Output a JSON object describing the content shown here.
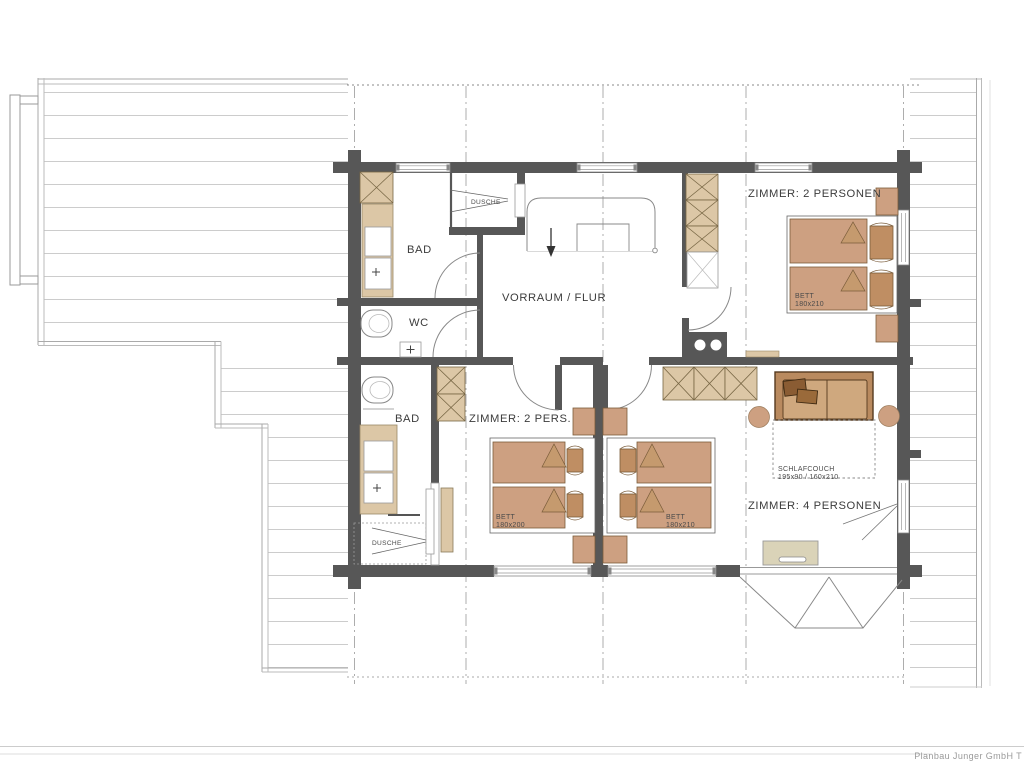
{
  "plan": {
    "rooms": {
      "bad_upper": {
        "name": "BAD"
      },
      "shower_upper": {
        "name": "DUSCHE"
      },
      "wc": {
        "name": "WC"
      },
      "hall": {
        "name": "VORRAUM / FLUR"
      },
      "bad_lower": {
        "name": "BAD"
      },
      "shower_lower": {
        "name": "DUSCHE"
      },
      "bedroom_small": {
        "name": "ZIMMER: 2 PERS."
      },
      "bedroom_top": {
        "name": "ZIMMER: 2 PERSONEN"
      },
      "bedroom_large": {
        "name": "ZIMMER: 4 PERSONEN"
      }
    },
    "furniture_labels": {
      "bed_small": {
        "line1": "BETT",
        "line2": "180x200"
      },
      "bed_top": {
        "line1": "BETT",
        "line2": "180x210"
      },
      "bed_large": {
        "line1": "BETT",
        "line2": "180x210"
      },
      "sofa": {
        "line1": "SCHLAFCOUCH",
        "line2": "195x90 / 160x210"
      }
    },
    "footer": {
      "credit": "Planbau Junger GmbH T"
    },
    "colors": {
      "wall": "#575757",
      "wood": "#cda081",
      "wood_light": "#dcc7a6",
      "wood_dark": "#bf8e63",
      "sofa_base": "#b98a5f",
      "sofa_seat": "#cfa87e",
      "sofa_cushion": "#8a5c33",
      "chest": "#dad3b8",
      "deck_line": "#cccccc",
      "text": "#3c3c3c"
    }
  }
}
